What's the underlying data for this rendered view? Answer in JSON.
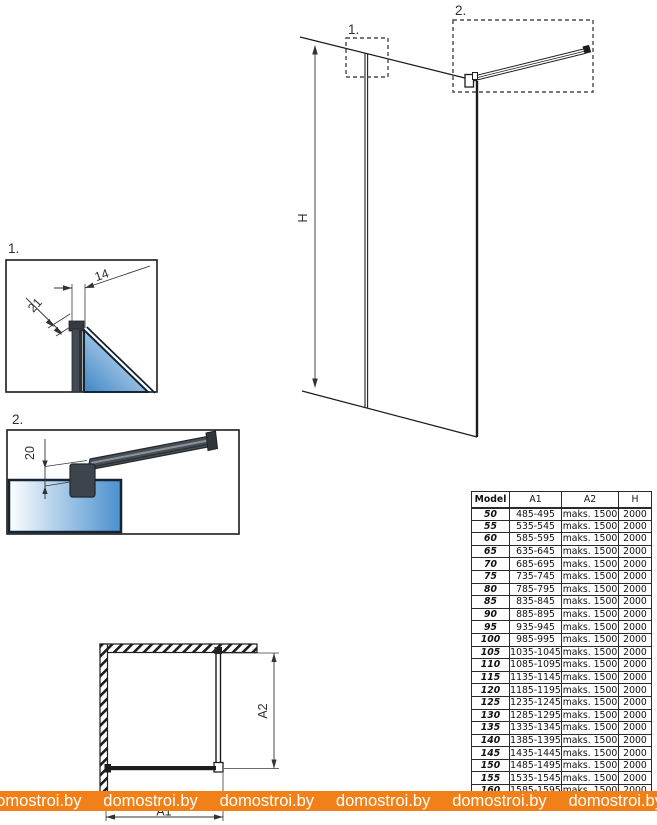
{
  "page": {
    "width": 657,
    "height": 825,
    "background": "#ffffff"
  },
  "elevation": {
    "callout_1": "1.",
    "callout_2": "2.",
    "height_label": "H"
  },
  "detail_1": {
    "label": "1.",
    "profile_width_mm": "14",
    "profile_depth_mm": "21"
  },
  "detail_2": {
    "label": "2.",
    "bar_offset_mm": "20"
  },
  "plan": {
    "width_label": "A1",
    "depth_label": "A2"
  },
  "table": {
    "headers": [
      "Model",
      "A1",
      "A2",
      "H"
    ],
    "rows": [
      {
        "model": "50",
        "a1": "485-495",
        "a2": "maks. 1500",
        "h": "2000"
      },
      {
        "model": "55",
        "a1": "535-545",
        "a2": "maks. 1500",
        "h": "2000"
      },
      {
        "model": "60",
        "a1": "585-595",
        "a2": "maks. 1500",
        "h": "2000"
      },
      {
        "model": "65",
        "a1": "635-645",
        "a2": "maks. 1500",
        "h": "2000"
      },
      {
        "model": "70",
        "a1": "685-695",
        "a2": "maks. 1500",
        "h": "2000"
      },
      {
        "model": "75",
        "a1": "735-745",
        "a2": "maks. 1500",
        "h": "2000"
      },
      {
        "model": "80",
        "a1": "785-795",
        "a2": "maks. 1500",
        "h": "2000"
      },
      {
        "model": "85",
        "a1": "835-845",
        "a2": "maks. 1500",
        "h": "2000"
      },
      {
        "model": "90",
        "a1": "885-895",
        "a2": "maks. 1500",
        "h": "2000"
      },
      {
        "model": "95",
        "a1": "935-945",
        "a2": "maks. 1500",
        "h": "2000"
      },
      {
        "model": "100",
        "a1": "985-995",
        "a2": "maks. 1500",
        "h": "2000"
      },
      {
        "model": "105",
        "a1": "1035-1045",
        "a2": "maks. 1500",
        "h": "2000"
      },
      {
        "model": "110",
        "a1": "1085-1095",
        "a2": "maks. 1500",
        "h": "2000"
      },
      {
        "model": "115",
        "a1": "1135-1145",
        "a2": "maks. 1500",
        "h": "2000"
      },
      {
        "model": "120",
        "a1": "1185-1195",
        "a2": "maks. 1500",
        "h": "2000"
      },
      {
        "model": "125",
        "a1": "1235-1245",
        "a2": "maks. 1500",
        "h": "2000"
      },
      {
        "model": "130",
        "a1": "1285-1295",
        "a2": "maks. 1500",
        "h": "2000"
      },
      {
        "model": "135",
        "a1": "1335-1345",
        "a2": "maks. 1500",
        "h": "2000"
      },
      {
        "model": "140",
        "a1": "1385-1395",
        "a2": "maks. 1500",
        "h": "2000"
      },
      {
        "model": "145",
        "a1": "1435-1445",
        "a2": "maks. 1500",
        "h": "2000"
      },
      {
        "model": "150",
        "a1": "1485-1495",
        "a2": "maks. 1500",
        "h": "2000"
      },
      {
        "model": "155",
        "a1": "1535-1545",
        "a2": "maks. 1500",
        "h": "2000"
      },
      {
        "model": "160",
        "a1": "1585-1595",
        "a2": "maks. 1500",
        "h": "2000"
      }
    ]
  },
  "watermark": {
    "text": "domostroi.by",
    "background": "#f28018",
    "text_color": "#ffffff"
  },
  "colors": {
    "line": "#1c1c1c",
    "glass_light": "#e8f2fa",
    "glass_blue": "#3f86c6",
    "glass_edge": "#142536",
    "metal_dark": "#3f454b"
  }
}
